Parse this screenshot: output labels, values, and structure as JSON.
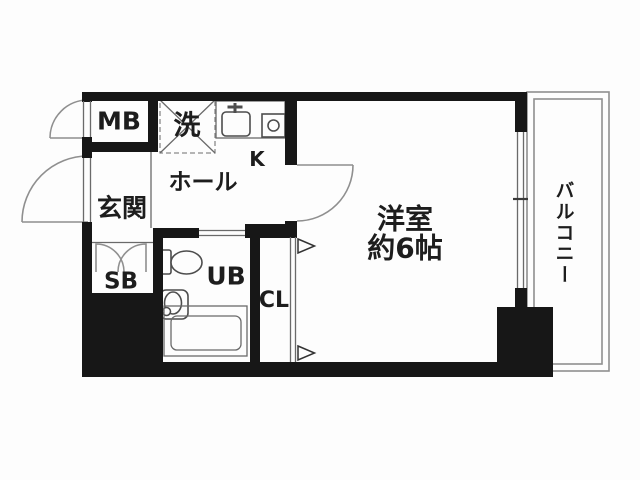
{
  "floorplan": {
    "labels": {
      "meter_box": "MB",
      "laundry": "洗",
      "kitchen": "K",
      "hall": "ホール",
      "entrance": "玄関",
      "shoe_box": "SB",
      "unit_bath": "UB",
      "closet": "CL",
      "western_room_name": "洋室",
      "western_room_size": "約6帖",
      "balcony": "バルコニー"
    },
    "colors": {
      "wall": "#171717",
      "thin_line": "#4d4d4d",
      "light_line": "#8f8f8f",
      "background": "#fdfdfd",
      "text": "#1d1d1d"
    }
  }
}
